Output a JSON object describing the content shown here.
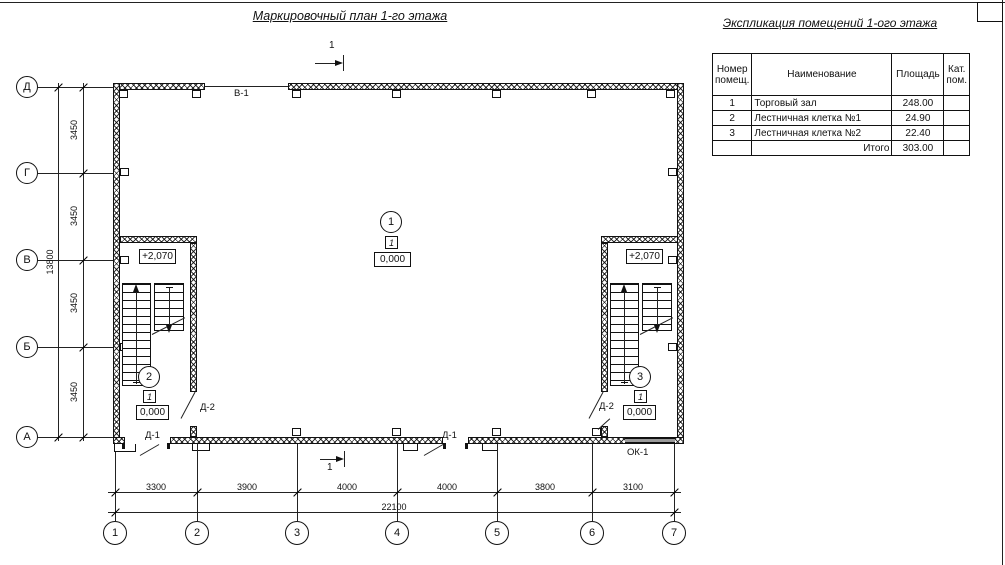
{
  "plan_title": "Маркировочный план 1-го этажа",
  "table_title": "Экспликация помещений 1-ого этажа",
  "axes": {
    "rows": [
      "Д",
      "Г",
      "В",
      "Б",
      "А"
    ],
    "cols": [
      "1",
      "2",
      "3",
      "4",
      "5",
      "6",
      "7"
    ]
  },
  "dims": {
    "v_segments": [
      "3450",
      "3450",
      "3450",
      "3450"
    ],
    "v_total": "13800",
    "h_segments": [
      "3300",
      "3900",
      "4000",
      "4000",
      "3800",
      "3100"
    ],
    "h_total": "22100"
  },
  "labels": {
    "window_top": "В-1",
    "door_entry": "Д-1",
    "door_stair": "Д-2",
    "window_bottom": "ОК-1",
    "section_mark": "1"
  },
  "markers": {
    "hall": {
      "number": "1",
      "type": "1",
      "level": "0,000"
    },
    "stair_left": {
      "number": "2",
      "type": "1",
      "level": "0,000",
      "upper_level": "+2,070"
    },
    "stair_right": {
      "number": "3",
      "type": "1",
      "level": "0,000",
      "upper_level": "+2,070"
    }
  },
  "table": {
    "headers": {
      "number": "Номер\nпомещ.",
      "name": "Наименование",
      "area": "Площадь",
      "category": "Кат.\nпом."
    },
    "rows": [
      {
        "number": "1",
        "name": "Торговый зал",
        "area": "248.00",
        "category": ""
      },
      {
        "number": "2",
        "name": "Лестничная клетка №1",
        "area": "24.90",
        "category": ""
      },
      {
        "number": "3",
        "name": "Лестничная клетка №2",
        "area": "22.40",
        "category": ""
      }
    ],
    "total_label": "Итого",
    "total_value": "303.00"
  }
}
